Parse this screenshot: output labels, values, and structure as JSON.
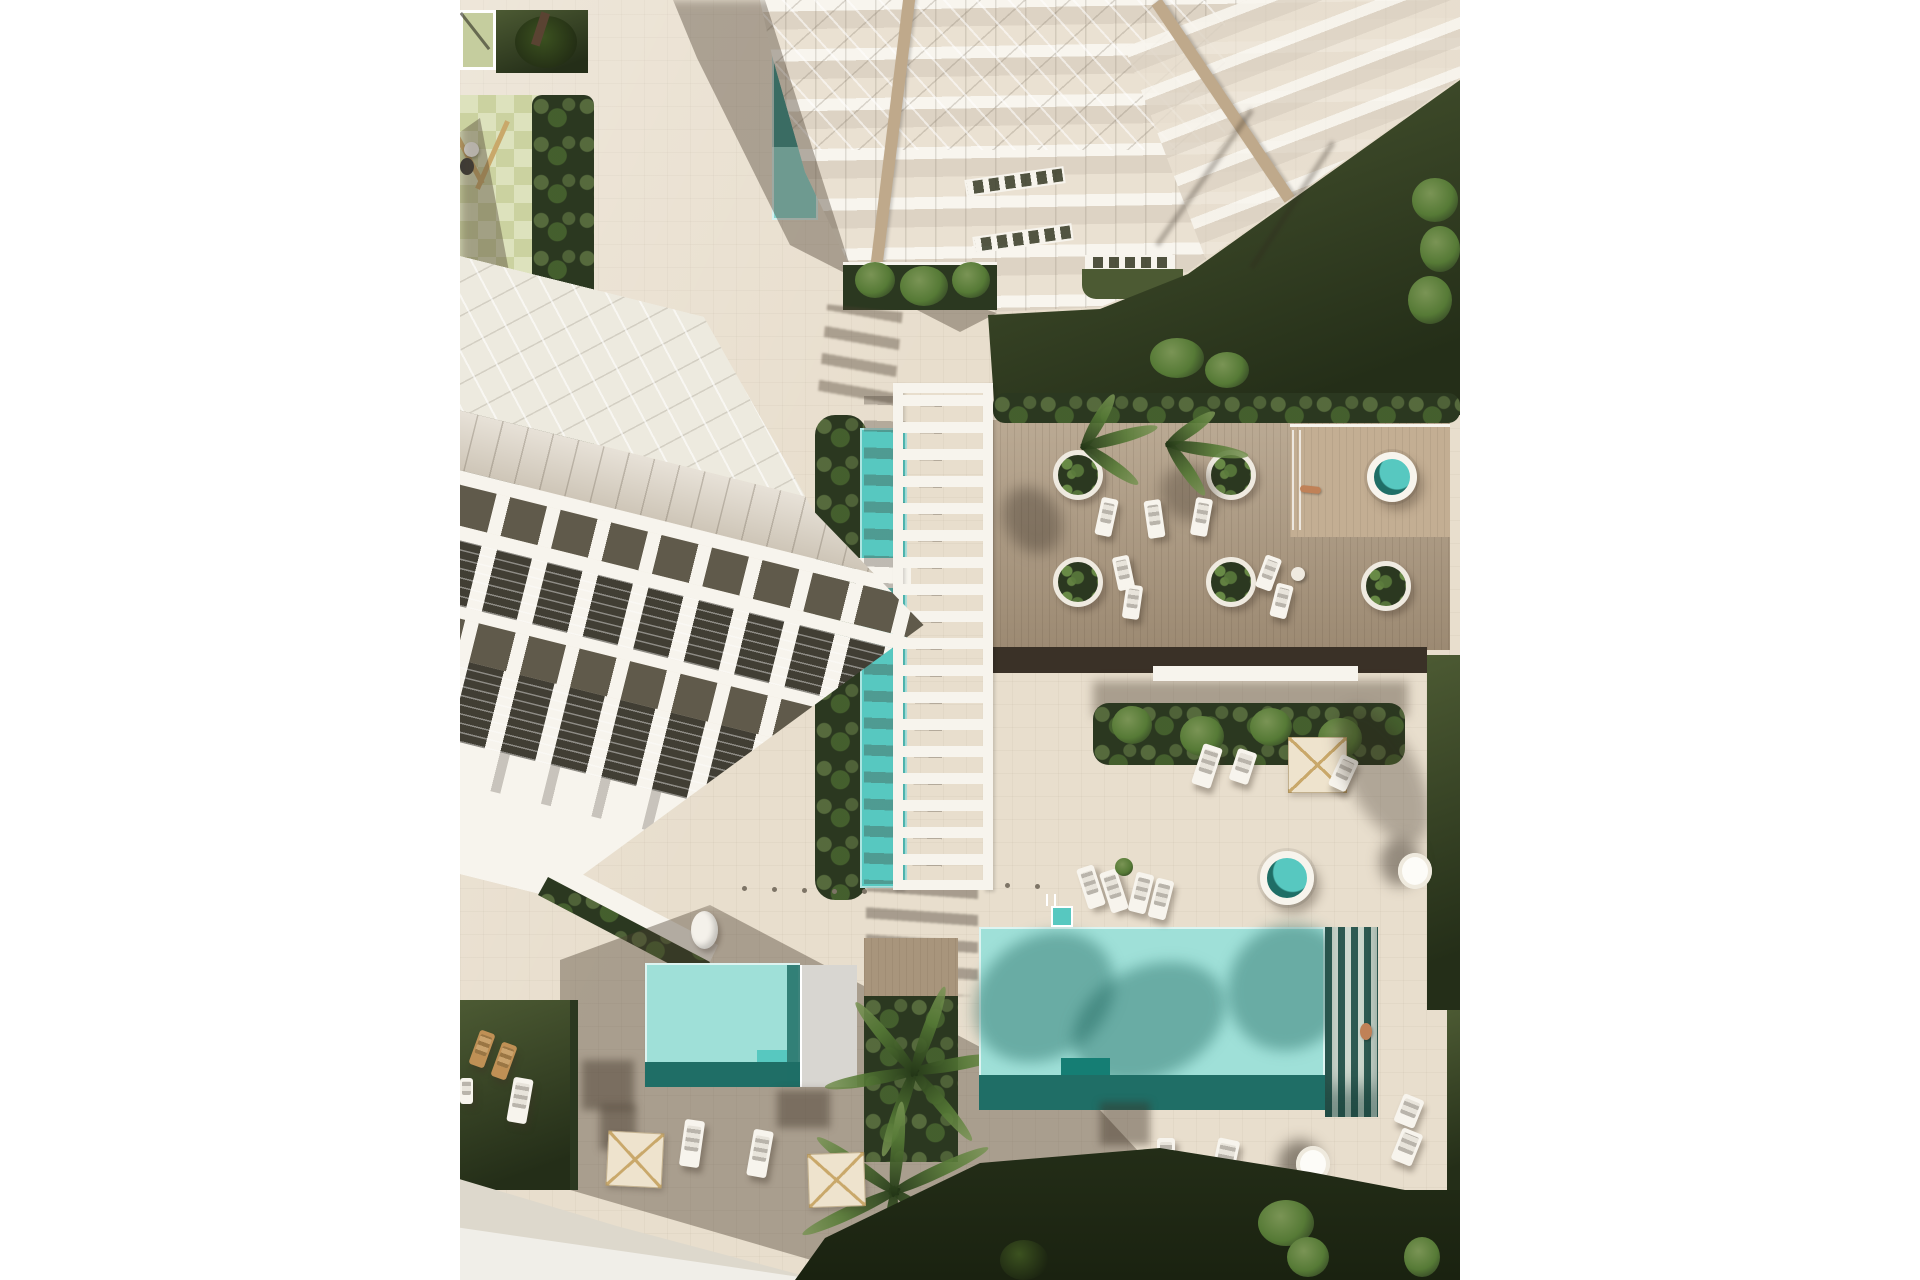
{
  "meta": {
    "type": "architectural-aerial-render",
    "description": "Top-down aerial 3D rendering of a beachfront apartment complex: two white terraced buildings, a central white pergola walkway with a narrow lap pool, a wooden amenity deck with circular planters, two round spas, a large turquoise swimming pool and a smaller kids pool, lawns, palm trees, cream parasols and sun loungers on beige paving"
  },
  "palette": {
    "paving": "#e8decd",
    "paving-shade": "#cdbfa9",
    "road": "#ddd8cc",
    "road-light": "#f0eee8",
    "wood": "#b19e85",
    "wood-light": "#c3ae93",
    "wood-path": "#a8957c",
    "deck-rim": "#3a3127",
    "lawn": "#4c5a33",
    "lawn-dark": "#242e18",
    "hedge": "#2b3820",
    "leaf": "#567a36",
    "leaf-light": "#7a9455",
    "checker-a": "#cbd2a0",
    "checker-b": "#dde2bd",
    "canopy": "#c5cd9e",
    "pool-light": "#9fe0d8",
    "pool-mid": "#57c8c0",
    "pool-dark": "#1f6e66",
    "slat-dark": "#2e5a52",
    "slat-light": "#cfd9cf",
    "struct-white": "#f7f4ed",
    "glass": "#dbd2c3",
    "cell-dark": "#605a4b",
    "window-dark": "#413e34",
    "tan": "#bf9055",
    "spine-tan": "#bfa98b",
    "cream": "#eee3cd",
    "parasol-line": "#c9a86a",
    "skin": "#c08157",
    "gray-platform": "#d8d6d1",
    "bench": "#9b9487",
    "shadow": "rgba(76,62,47,0.40)"
  },
  "inventory": {
    "buildings": [
      {
        "id": "tower-north",
        "label": "terraced tower with glass balconies and two tan stair spines"
      },
      {
        "id": "slab-west",
        "label": "terraced slab building with dark balcony awnings and window bays"
      }
    ],
    "water_features": [
      {
        "id": "main-pool",
        "label": "large turquoise pool with palm shadows and dark slat edge"
      },
      {
        "id": "kids-pool",
        "label": "small turquoise pool with gray lounge platform"
      },
      {
        "id": "lap-pool",
        "label": "narrow lap pool under pergola"
      },
      {
        "id": "tower-pool",
        "label": "small pool at tower base"
      },
      {
        "id": "deck-spa",
        "label": "round spa on raised deck platform"
      },
      {
        "id": "paving-spa",
        "label": "round spa on paving"
      }
    ],
    "amenities": {
      "pergola": 1,
      "circular_planters": 5,
      "parasols": 5,
      "loungers": 20,
      "benches": 3,
      "playground": 1,
      "palm_trees": 6,
      "people": 2
    }
  }
}
